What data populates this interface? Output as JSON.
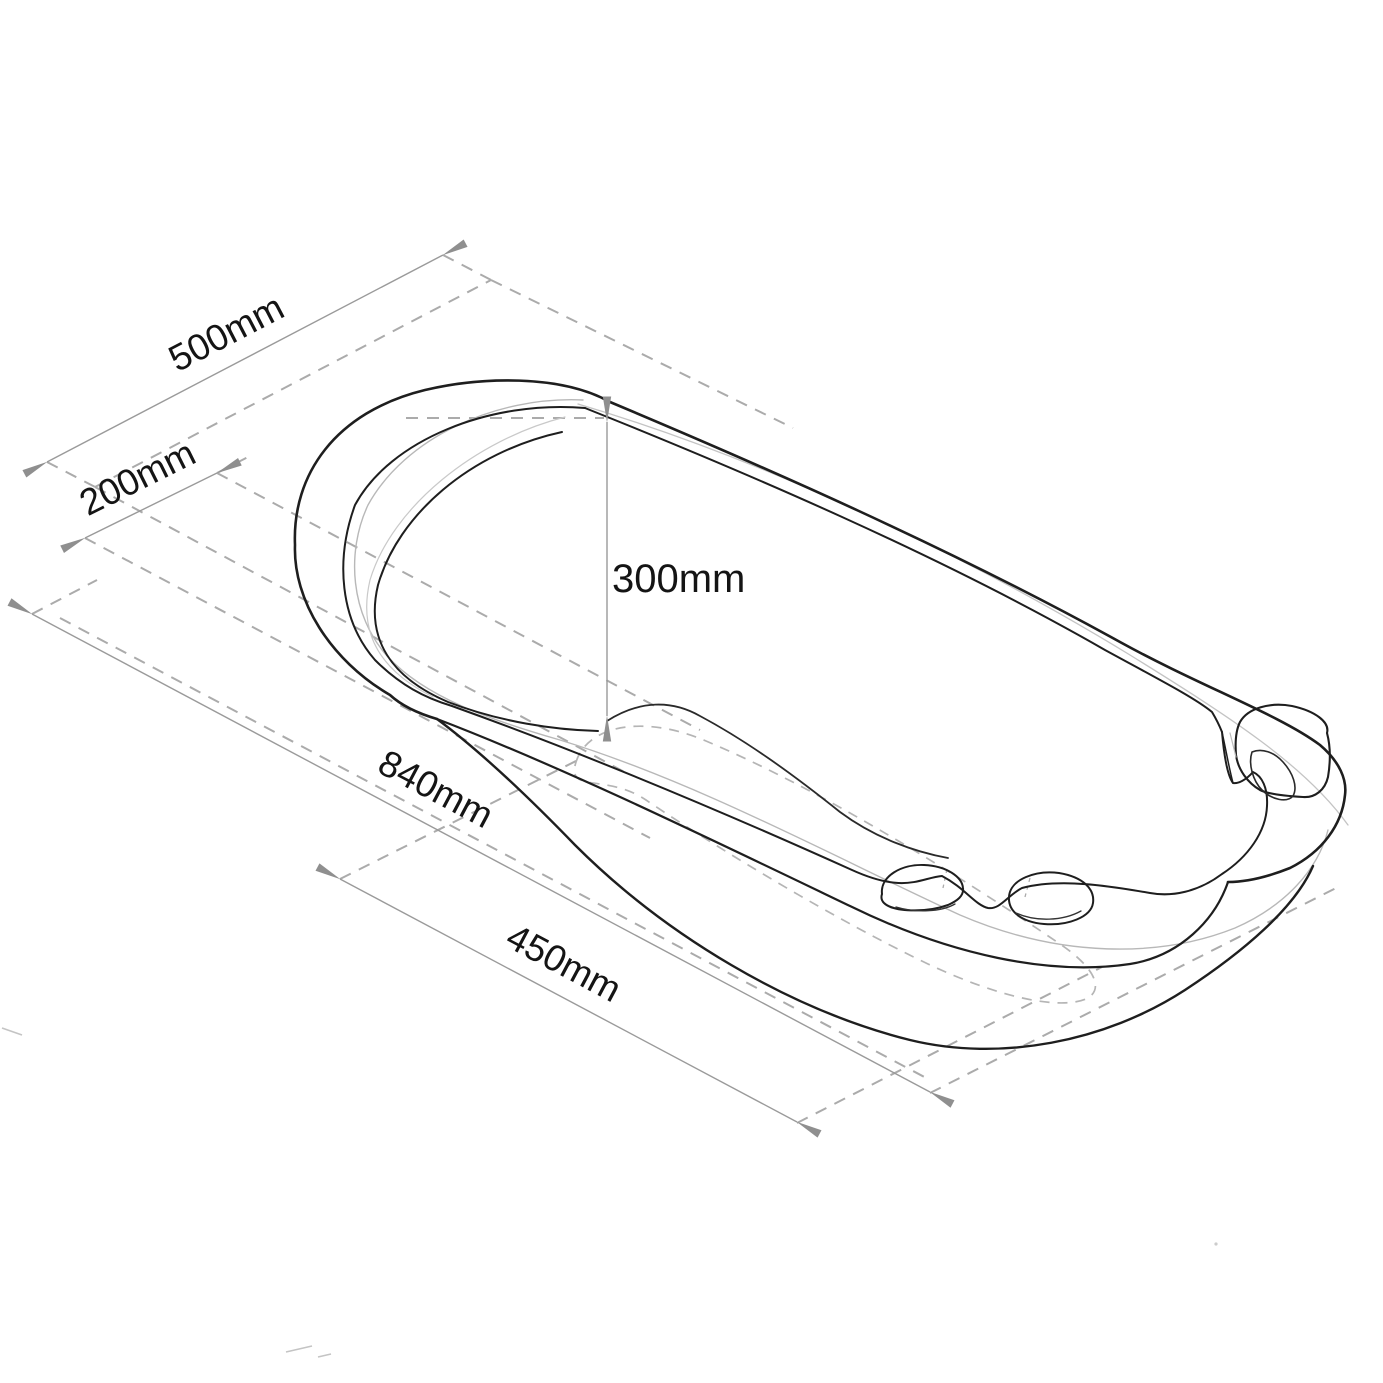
{
  "diagram": {
    "kind": "isometric technical line drawing of a baby bath tub with dimension annotations",
    "dimensions": {
      "top_width_label": "500mm",
      "base_width_label": "200mm",
      "height_label": "300mm",
      "overall_length_label": "840mm",
      "base_length_label": "450mm"
    },
    "colors": {
      "background": "#ffffff",
      "outline": "#1e1e1e",
      "secondary_line": "#b8b8b8",
      "dimension_line": "#9a9a9a",
      "dashed_line": "#ababab",
      "arrowhead": "#8f8f8f",
      "label_text": "#141414"
    }
  }
}
